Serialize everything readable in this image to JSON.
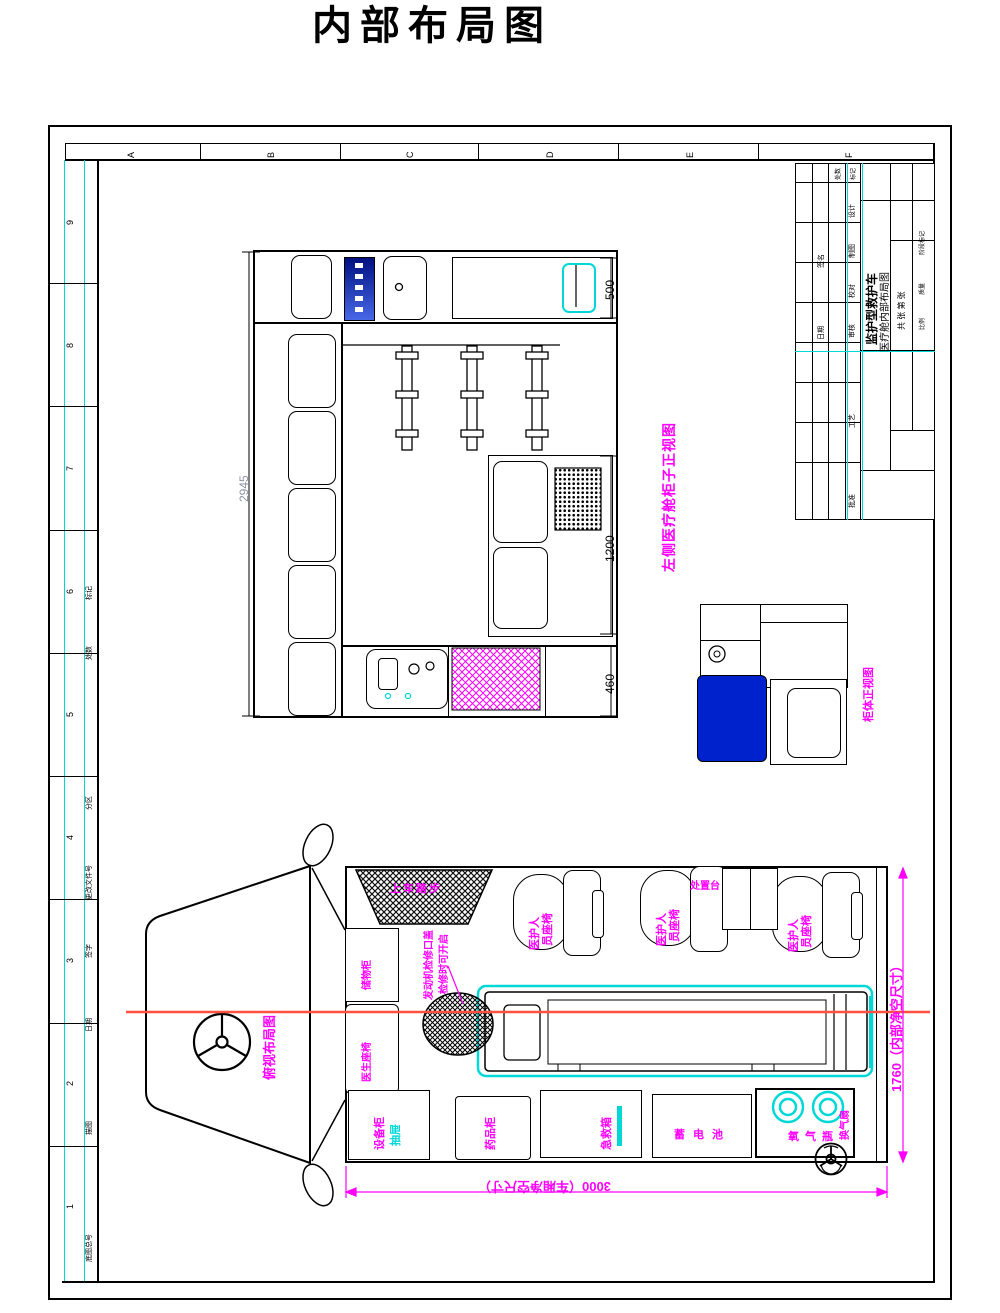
{
  "page": {
    "title": "内部布局图"
  },
  "colors": {
    "magenta": "#FF00FF",
    "cyan": "#00D8D8",
    "seat_blue": "#0022CC",
    "centerline_red": "#FF5040",
    "dim_gray": "#9090A8"
  },
  "frame": {
    "cols": [
      "A",
      "B",
      "C",
      "D",
      "E",
      "F"
    ],
    "rows": [
      "9",
      "8",
      "7",
      "6",
      "5",
      "4",
      "3",
      "2",
      "1"
    ],
    "rev": [
      "标记",
      "处数",
      "分区",
      "更改文件号",
      "签字",
      "日期",
      "描图",
      "底图总号"
    ]
  },
  "title_block": {
    "sign_rows": [
      "设计",
      "制图",
      "校对",
      "审核",
      "工艺",
      "批准"
    ],
    "sign_label": "签名",
    "date_label": "日期",
    "mark_label": "标记",
    "count_label": "处数",
    "product": "监护型救护车",
    "drawing_title": "医疗舱内部布局图",
    "sheet_note": "共 张 第 张",
    "stage": "阶段标记",
    "mass": "质量",
    "scale": "比例"
  },
  "elevation": {
    "label": "左侧医疗舱柜子正视图",
    "dim_total": "2945",
    "dim_top": "500",
    "dim_mid": "1200",
    "dim_bench": "460"
  },
  "detail": {
    "label": "柜体正视图"
  },
  "plan": {
    "view_label": "俯视布局图",
    "step": "上车踏步",
    "seat_col1": "医护人",
    "seat_col2": "员座椅",
    "table": "处置台",
    "engine_line1": "发动机检修口盖",
    "engine_line2": "检修时可开启",
    "cab_box1": "储物柜",
    "cab_box2": "医生座椅",
    "box_a": "设备柜",
    "box_a_sub": "抽屉",
    "box_b": "药品柜",
    "box_c": "急救箱",
    "battery": "蓄电池",
    "oxygen": "氧气瓶",
    "fan": "换气扇",
    "dim_width": "1760（内部净空尺寸）",
    "dim_length": "3000（车厢净空尺寸）"
  }
}
